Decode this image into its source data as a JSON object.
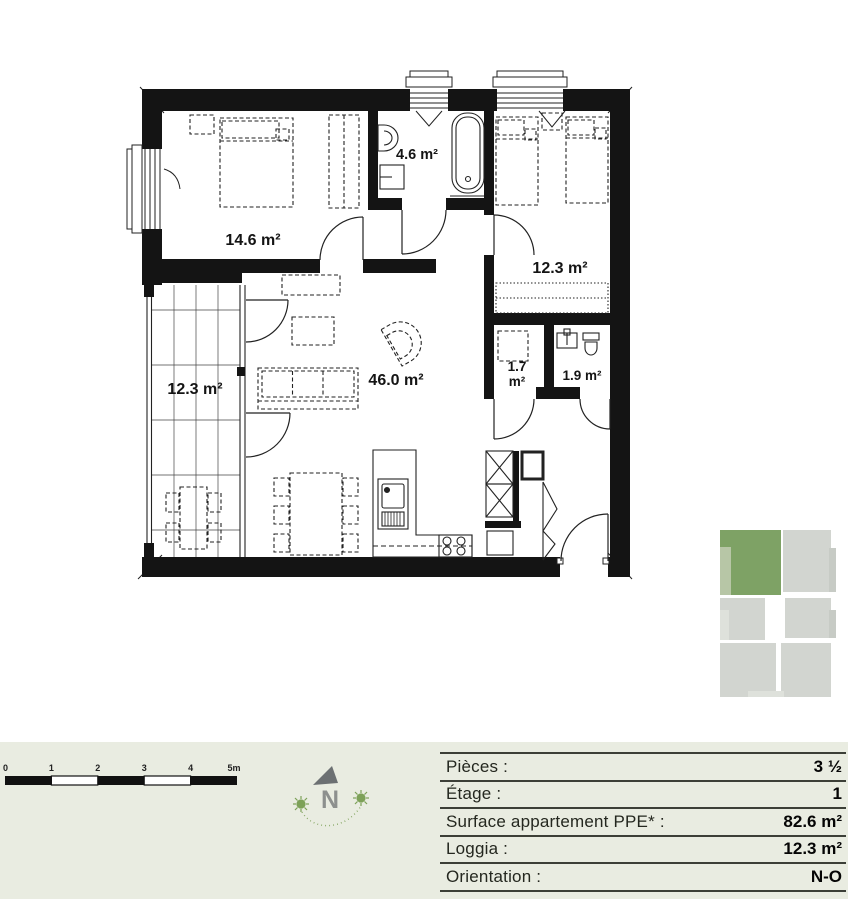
{
  "plan": {
    "rooms": [
      {
        "id": "bedroom-1",
        "area_label": "14.6 m²"
      },
      {
        "id": "bathroom",
        "area_label": "4.6 m²"
      },
      {
        "id": "bedroom-2",
        "area_label": "12.3 m²"
      },
      {
        "id": "living-kitchen",
        "area_label": "46.0 m²"
      },
      {
        "id": "reduit",
        "area_label_value": "1.7",
        "area_label_unit": "m²"
      },
      {
        "id": "wc",
        "area_label": "1.9 m²"
      },
      {
        "id": "loggia",
        "area_label": "12.3 m²"
      }
    ]
  },
  "minimap": {
    "highlighted_unit_color": "#7ea265",
    "unit_color": "#d2d5d0"
  },
  "footer": {
    "scalebar": {
      "ticks": [
        "0",
        "1",
        "2",
        "3",
        "4",
        "5m"
      ]
    },
    "compass": {
      "north_label": "N"
    },
    "info_table": {
      "rows": [
        {
          "label": "Pièces :",
          "value": "3 ½"
        },
        {
          "label": "Étage :",
          "value": "1"
        },
        {
          "label": "Surface appartement PPE* :",
          "value": "82.6 m²"
        },
        {
          "label": "Loggia :",
          "value": "12.3 m²"
        },
        {
          "label": "Orientation :",
          "value": "N-O"
        }
      ]
    }
  },
  "colors": {
    "footer_bg": "#e9ece1",
    "wall": "#141414",
    "accent_green": "#7ea265",
    "compass_green": "#7da158",
    "compass_gray": "#6c7072"
  }
}
